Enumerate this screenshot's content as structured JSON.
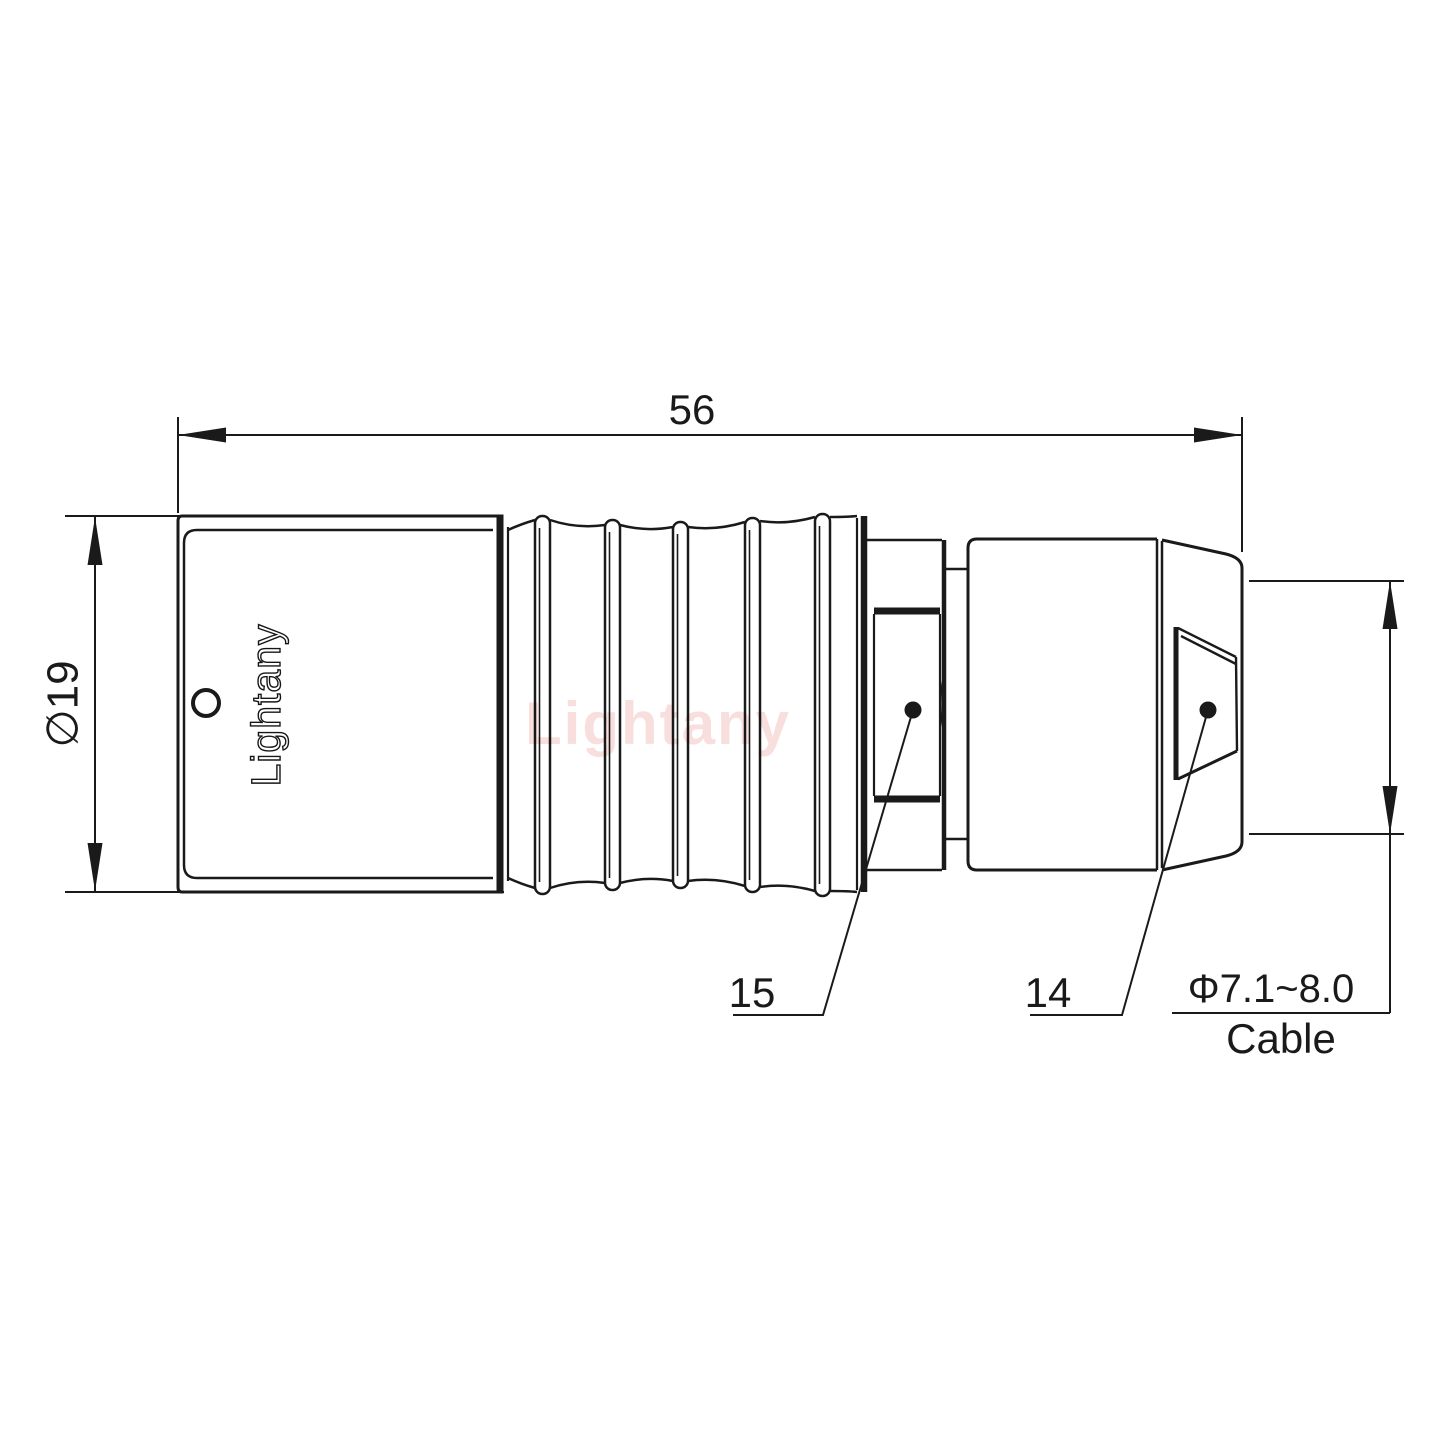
{
  "document": {
    "background_color": "#ffffff",
    "line_color": "#1a1a1a",
    "type": "connector-technical-drawing"
  },
  "dimensions": {
    "overall_length_mm": "56",
    "body_diameter": "∅19",
    "cable_diameter_range": "Φ7.1~8.0",
    "cable_caption": "Cable"
  },
  "callouts": {
    "contact_part": "15",
    "strain_relief_part": "14"
  },
  "branding": {
    "engraved_logo": "Lightany",
    "watermark": "Lightany",
    "watermark_color": "#f5c9c9"
  }
}
